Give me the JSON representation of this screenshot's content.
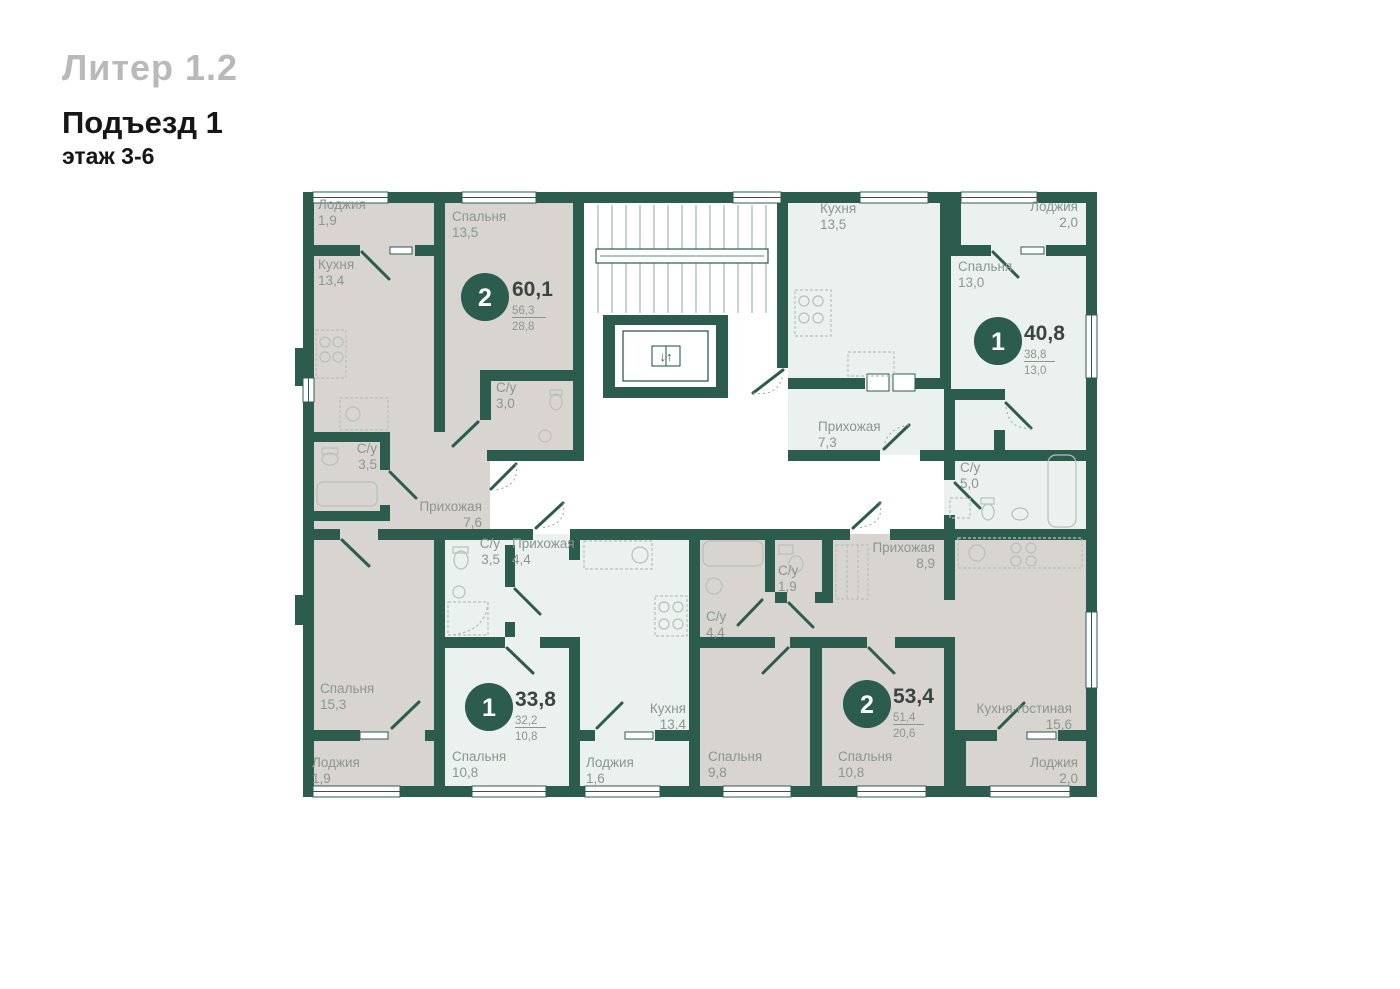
{
  "header": {
    "liter": "Литер 1.2",
    "entrance": "Подъезд 1",
    "floor": "этаж 3-6"
  },
  "colors": {
    "wall": "#2c5c4e",
    "two_room_fill": "#d8d4d0",
    "one_room_fill": "#eaf1ee",
    "common_area_fill": "#ffffff",
    "room_label": "#8c968f",
    "area_value_dark": "#3c4441",
    "badge_leaf": "#2c5c4e",
    "header_muted": "#b9b9b9",
    "header_dark": "#161616"
  },
  "core": {
    "elevator_symbol": "↓↑"
  },
  "apartments": [
    {
      "type": "2",
      "area_total": "60,1",
      "area_no_balcony": "56,3",
      "area_living": "28,8",
      "rooms": [
        {
          "name": "Лоджия",
          "area": "1,9"
        },
        {
          "name": "Кухня",
          "area": "13,4"
        },
        {
          "name": "Спальня",
          "area": "13,5"
        },
        {
          "name": "С/у",
          "area": "3,0"
        },
        {
          "name": "С/у",
          "area": "3,5"
        },
        {
          "name": "Прихожая",
          "area": "7,6"
        },
        {
          "name": "Спальня",
          "area": "15,3"
        },
        {
          "name": "Лоджия",
          "area": "1,9"
        }
      ]
    },
    {
      "type": "1",
      "area_total": "40,8",
      "area_no_balcony": "38,8",
      "area_living": "13,0",
      "rooms": [
        {
          "name": "Кухня",
          "area": "13,5"
        },
        {
          "name": "Лоджия",
          "area": "2,0"
        },
        {
          "name": "Спальня",
          "area": "13,0"
        },
        {
          "name": "Прихожая",
          "area": "7,3"
        },
        {
          "name": "С/у",
          "area": "5,0"
        }
      ]
    },
    {
      "type": "1",
      "area_total": "33,8",
      "area_no_balcony": "32,2",
      "area_living": "10,8",
      "rooms": [
        {
          "name": "С/у",
          "area": "3,5"
        },
        {
          "name": "Прихожая",
          "area": "4,4"
        },
        {
          "name": "Кухня",
          "area": "13,4"
        },
        {
          "name": "Спальня",
          "area": "10,8"
        },
        {
          "name": "Лоджия",
          "area": "1,6"
        }
      ]
    },
    {
      "type": "2",
      "area_total": "53,4",
      "area_no_balcony": "51,4",
      "area_living": "20,6",
      "rooms": [
        {
          "name": "С/у",
          "area": "1,9"
        },
        {
          "name": "С/у",
          "area": "4,4"
        },
        {
          "name": "Прихожая",
          "area": "8,9"
        },
        {
          "name": "Спальня",
          "area": "9,8"
        },
        {
          "name": "Спальня",
          "area": "10,8"
        },
        {
          "name": "Кухня-гостиная",
          "area": "15,6"
        },
        {
          "name": "Лоджия",
          "area": "2,0"
        }
      ]
    }
  ]
}
